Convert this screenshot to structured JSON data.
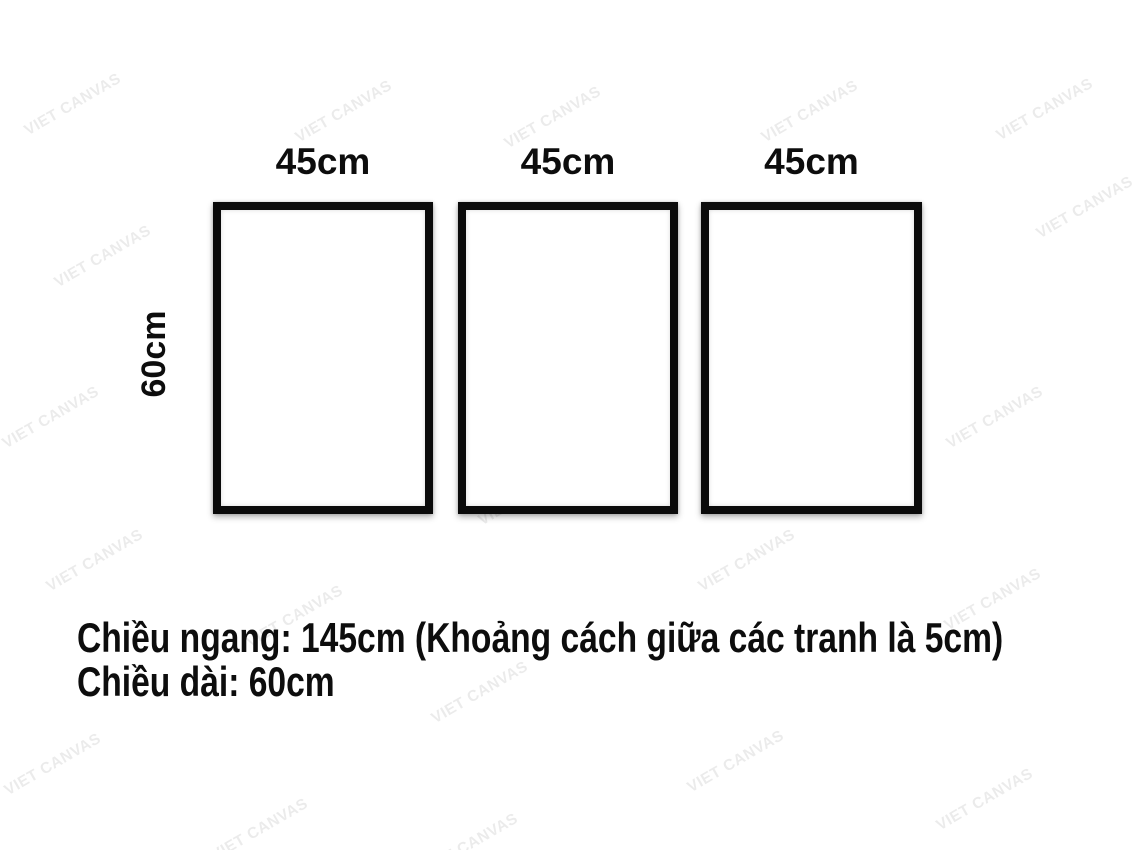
{
  "diagram": {
    "frames": [
      {
        "width_label": "45cm"
      },
      {
        "width_label": "45cm"
      },
      {
        "width_label": "45cm"
      }
    ],
    "height_label": "60cm",
    "caption": {
      "line1": "Chiều ngang: 145cm (Khoảng cách giữa các tranh là 5cm)",
      "line2": "Chiều dài: 60cm"
    }
  },
  "watermark": {
    "text": "VIET CANVAS",
    "color": "#000000",
    "opacity": 0.08,
    "angle_deg": -30,
    "positions": [
      {
        "x": 73,
        "y": 105
      },
      {
        "x": 344,
        "y": 112
      },
      {
        "x": 553,
        "y": 118
      },
      {
        "x": 810,
        "y": 112
      },
      {
        "x": 1045,
        "y": 110
      },
      {
        "x": 1085,
        "y": 208
      },
      {
        "x": 103,
        "y": 257
      },
      {
        "x": 293,
        "y": 277
      },
      {
        "x": 552,
        "y": 287
      },
      {
        "x": 798,
        "y": 355
      },
      {
        "x": 51,
        "y": 418
      },
      {
        "x": 344,
        "y": 418
      },
      {
        "x": 995,
        "y": 418
      },
      {
        "x": 527,
        "y": 495
      },
      {
        "x": 95,
        "y": 561
      },
      {
        "x": 747,
        "y": 561
      },
      {
        "x": 993,
        "y": 600
      },
      {
        "x": 295,
        "y": 617
      },
      {
        "x": 480,
        "y": 693
      },
      {
        "x": 53,
        "y": 765
      },
      {
        "x": 736,
        "y": 762
      },
      {
        "x": 985,
        "y": 800
      },
      {
        "x": 260,
        "y": 830
      },
      {
        "x": 470,
        "y": 845
      }
    ]
  },
  "colors": {
    "background": "#ffffff",
    "frame_border": "#0b0b0b",
    "text": "#0d0d0d"
  }
}
